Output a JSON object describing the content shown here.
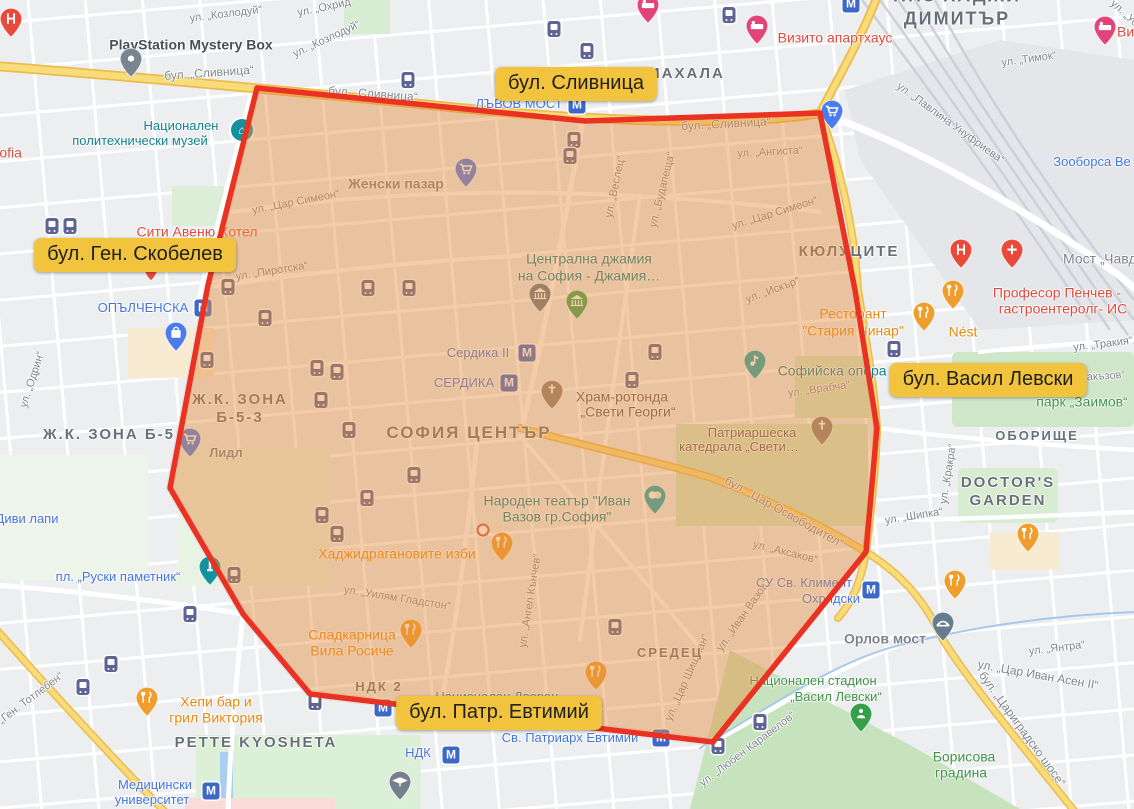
{
  "map": {
    "region": {
      "polygon_points": [
        [
          257,
          88
        ],
        [
          585,
          121
        ],
        [
          820,
          113
        ],
        [
          855,
          290
        ],
        [
          877,
          428
        ],
        [
          866,
          552
        ],
        [
          713,
          742
        ],
        [
          310,
          694
        ],
        [
          243,
          614
        ],
        [
          170,
          488
        ],
        [
          208,
          285
        ]
      ],
      "fill": "#e78f3f",
      "fill_opacity": 0.45,
      "stroke": "#ea3223",
      "stroke_width": 5.5
    },
    "callouts": [
      {
        "text": "бул. Сливница",
        "x": 576,
        "y": 84
      },
      {
        "text": "бул. Ген. Скобелев",
        "x": 135,
        "y": 255
      },
      {
        "text": "бул. Васил Левски",
        "x": 988,
        "y": 380
      },
      {
        "text": "бул. Патр. Евтимий",
        "x": 499,
        "y": 713
      }
    ],
    "labels": [
      {
        "t": "ул. „Козлодуй“",
        "x": 226,
        "y": 15,
        "c": "st",
        "r": -7
      },
      {
        "t": "ул. „Козлодуй“",
        "x": 327,
        "y": 40,
        "c": "st",
        "r": -25
      },
      {
        "t": "ул. „Охрид“",
        "x": 326,
        "y": 8,
        "c": "st",
        "r": -12
      },
      {
        "t": "бул. „Сливница“",
        "x": 209,
        "y": 73,
        "c": "st",
        "fs": 12,
        "r": -4
      },
      {
        "t": "бул. „Сливница“",
        "x": 373,
        "y": 94,
        "c": "st",
        "fs": 12,
        "r": 4
      },
      {
        "t": "бул. „Сливница“",
        "x": 726,
        "y": 124,
        "c": "st",
        "fs": 12,
        "r": -3
      },
      {
        "t": "ул. „Тимок“",
        "x": 1029,
        "y": 60,
        "c": "st",
        "r": -8
      },
      {
        "t": "ул. „Павлина Унуфриева“",
        "x": 950,
        "y": 124,
        "c": "st",
        "r": 36
      },
      {
        "t": "ул. „Уо",
        "x": 1124,
        "y": 14,
        "c": "st",
        "r": 42
      },
      {
        "t": "ул. „Ангиста“",
        "x": 770,
        "y": 153,
        "c": "st",
        "r": -3
      },
      {
        "t": "ул. „Веслец“",
        "x": 616,
        "y": 187,
        "c": "st",
        "r": -78
      },
      {
        "t": "ул. „Будапеща“",
        "x": 663,
        "y": 190,
        "c": "st",
        "r": -76
      },
      {
        "t": "ул. „Цар Симеон“",
        "x": 296,
        "y": 203,
        "c": "st",
        "r": -11
      },
      {
        "t": "ул. „Цар Симеон“",
        "x": 775,
        "y": 214,
        "c": "st",
        "r": -17
      },
      {
        "t": "ул. „Пиротска“",
        "x": 272,
        "y": 272,
        "c": "st",
        "r": -9
      },
      {
        "t": "ул. „Искър“",
        "x": 773,
        "y": 291,
        "c": "st",
        "r": -20
      },
      {
        "t": "ул. „Одрин“",
        "x": 33,
        "y": 380,
        "c": "st",
        "r": -72
      },
      {
        "t": "ул. „Врабча“",
        "x": 819,
        "y": 390,
        "c": "st",
        "r": -8
      },
      {
        "t": "бул. „Цар Освободител“",
        "x": 784,
        "y": 512,
        "c": "st",
        "fs": 12,
        "r": 29
      },
      {
        "t": "ул. „Аксаков“",
        "x": 785,
        "y": 553,
        "c": "st",
        "r": 14
      },
      {
        "t": "ул. „Тракия“",
        "x": 1103,
        "y": 345,
        "c": "st",
        "r": -7
      },
      {
        "t": "ул. „Кракра“",
        "x": 949,
        "y": 474,
        "c": "st",
        "r": -81
      },
      {
        "t": "ул. „Шипка“",
        "x": 914,
        "y": 517,
        "c": "st",
        "r": -9
      },
      {
        "t": "ул. „Янтра“",
        "x": 1057,
        "y": 649,
        "c": "st",
        "r": -7
      },
      {
        "t": "ул. „Цар Иван Асен II“",
        "x": 1038,
        "y": 675,
        "c": "st",
        "fs": 12,
        "r": 10
      },
      {
        "t": "бул. „Цариградско шосе“",
        "x": 1022,
        "y": 729,
        "c": "st",
        "fs": 12,
        "r": 54
      },
      {
        "t": "ул. „Любен Каравелов“",
        "x": 748,
        "y": 750,
        "c": "st",
        "r": -37
      },
      {
        "t": "ул. „Уилям Гладстон“",
        "x": 397,
        "y": 599,
        "c": "st",
        "r": 9
      },
      {
        "t": "ул. „Ангел Кънчев“",
        "x": 531,
        "y": 601,
        "c": "st",
        "r": -81
      },
      {
        "t": "ул. „Цар Шишман“",
        "x": 688,
        "y": 678,
        "c": "st",
        "r": -66
      },
      {
        "t": "ул. „Иван Вазов“",
        "x": 744,
        "y": 616,
        "c": "st",
        "r": -55
      },
      {
        "t": "бул. „Ген. Тотлебен“",
        "x": 22,
        "y": 706,
        "c": "st",
        "r": -37
      },
      {
        "t": "акъзов“",
        "x": 1106,
        "y": 377,
        "c": "st",
        "r": -4
      },
      {
        "t": "Мост „Чавдар“",
        "x": 1110,
        "y": 259,
        "c": "st",
        "fs": 14
      },
      {
        "t": "МАХАЛА",
        "x": 686,
        "y": 74,
        "c": "area",
        "fs": 15
      },
      {
        "t": "НПЗ ХАДЖИ",
        "x": 957,
        "y": -4,
        "c": "area",
        "fs": 18
      },
      {
        "t": "ДИМИТЪР",
        "x": 957,
        "y": 19,
        "c": "area",
        "fs": 18
      },
      {
        "t": "КЮЛУЦИТЕ",
        "x": 849,
        "y": 252,
        "c": "area",
        "fs": 15
      },
      {
        "t": "Ж.К. ЗОНА Б-5",
        "x": 109,
        "y": 435,
        "c": "area",
        "fs": 15
      },
      {
        "t": "Ж.К. ЗОНА",
        "x": 240,
        "y": 400,
        "c": "area",
        "fs": 15
      },
      {
        "t": "Б-5-3",
        "x": 240,
        "y": 418,
        "c": "area",
        "fs": 15
      },
      {
        "t": "СОФИЯ ЦЕНТЪР",
        "x": 469,
        "y": 433,
        "c": "area",
        "fs": 17
      },
      {
        "t": "СРЕДЕЦ",
        "x": 670,
        "y": 653,
        "c": "area",
        "fs": 13
      },
      {
        "t": "ОБОРИЩЕ",
        "x": 1037,
        "y": 436,
        "c": "area",
        "fs": 13
      },
      {
        "t": "DOCTOR'S",
        "x": 1008,
        "y": 483,
        "c": "area",
        "fs": 15
      },
      {
        "t": "GARDEN",
        "x": 1008,
        "y": 501,
        "c": "area",
        "fs": 15
      },
      {
        "t": "PETTE KYOSHETA",
        "x": 256,
        "y": 743,
        "c": "area",
        "fs": 15
      },
      {
        "t": "НДК 2",
        "x": 379,
        "y": 687,
        "c": "area",
        "fs": 13
      },
      {
        "t": "ОПЪЛЧЕНСКА",
        "x": 143,
        "y": 308,
        "c": "blue",
        "fs": 13
      },
      {
        "t": "ЛЪВОВ МОСТ",
        "x": 519,
        "y": 104,
        "c": "blue",
        "fs": 13
      },
      {
        "t": "Сердика II",
        "x": 478,
        "y": 353,
        "c": "blue",
        "fs": 13
      },
      {
        "t": "СЕРДИКА",
        "x": 464,
        "y": 383,
        "c": "blue",
        "fs": 13
      },
      {
        "t": "Медицински",
        "x": 155,
        "y": 785,
        "c": "blue",
        "fs": 13
      },
      {
        "t": "университет",
        "x": 152,
        "y": 800,
        "c": "blue",
        "fs": 13
      },
      {
        "t": "НДК",
        "x": 418,
        "y": 753,
        "c": "blue",
        "fs": 13
      },
      {
        "t": "Св. Патриарх Евтимий",
        "x": 570,
        "y": 738,
        "c": "blue",
        "fs": 13
      },
      {
        "t": "СУ Св. Климент",
        "x": 804,
        "y": 583,
        "c": "blue",
        "fs": 13
      },
      {
        "t": "Охридски",
        "x": 831,
        "y": 599,
        "c": "blue",
        "fs": 13
      },
      {
        "t": "пл. „Руски паметник“",
        "x": 118,
        "y": 577,
        "c": "blue",
        "fs": 13
      },
      {
        "t": "Диви лапи",
        "x": 27,
        "y": 519,
        "c": "blue",
        "fs": 13
      },
      {
        "t": "Зооборса Ве",
        "x": 1092,
        "y": 162,
        "c": "blue",
        "fs": 13
      },
      {
        "t": "Национален",
        "x": 181,
        "y": 126,
        "c": "teal",
        "fs": 13
      },
      {
        "t": "политехнически музей",
        "x": 140,
        "y": 141,
        "c": "teal",
        "fs": 13
      },
      {
        "t": "Централна джамия",
        "x": 589,
        "y": 259,
        "c": "teal",
        "fs": 14
      },
      {
        "t": "на София - Джамия…",
        "x": 589,
        "y": 276,
        "c": "teal",
        "fs": 14
      },
      {
        "t": "Народен театър \"Иван",
        "x": 557,
        "y": 501,
        "c": "teal",
        "fs": 14
      },
      {
        "t": "Вазов гр.София\"",
        "x": 557,
        "y": 517,
        "c": "teal",
        "fs": 14
      },
      {
        "t": "Софийска опера и",
        "x": 838,
        "y": 371,
        "c": "teal",
        "fs": 14
      },
      {
        "t": "Национален Дворец",
        "x": 497,
        "y": 697,
        "c": "teal",
        "fs": 13
      },
      {
        "t": "Храм-ротонда",
        "x": 622,
        "y": 397,
        "c": "brown",
        "fs": 14
      },
      {
        "t": "„Свети Георги“",
        "x": 628,
        "y": 412,
        "c": "brown",
        "fs": 14
      },
      {
        "t": "Патриаршеска",
        "x": 752,
        "y": 433,
        "c": "brown",
        "fs": 13
      },
      {
        "t": "катедрала „Свети…",
        "x": 739,
        "y": 447,
        "c": "brown",
        "fs": 13
      },
      {
        "t": "Орлов мост",
        "x": 885,
        "y": 639,
        "c": "gray",
        "fs": 14
      },
      {
        "t": "Женски пазар",
        "x": 396,
        "y": 184,
        "c": "gray",
        "fs": 14
      },
      {
        "t": "Лидл",
        "x": 226,
        "y": 453,
        "c": "gray",
        "fs": 13
      },
      {
        "t": "PlayStation Mystery Box",
        "x": 191,
        "y": 45,
        "c": "dark",
        "fs": 14
      },
      {
        "t": "Sofia",
        "x": 6,
        "y": 153,
        "c": "red",
        "fs": 14
      },
      {
        "t": "Сити Авеню Хотел",
        "x": 197,
        "y": 232,
        "c": "red",
        "fs": 14
      },
      {
        "t": "Визито апартхаус",
        "x": 835,
        "y": 38,
        "c": "red",
        "fs": 14
      },
      {
        "t": "Визито апартхаус",
        "x": 1117,
        "y": 32,
        "c": "red",
        "fs": 14,
        "a": "l"
      },
      {
        "t": "Професор Пенчев -",
        "x": 1057,
        "y": 293,
        "c": "red",
        "fs": 14
      },
      {
        "t": "гастроентеролг- ИС",
        "x": 1063,
        "y": 309,
        "c": "red",
        "fs": 14
      },
      {
        "t": "Ресторант",
        "x": 853,
        "y": 314,
        "c": "orange",
        "fs": 14
      },
      {
        "t": "\"Стария Чинар\"",
        "x": 853,
        "y": 331,
        "c": "orange",
        "fs": 14
      },
      {
        "t": "Nést",
        "x": 963,
        "y": 332,
        "c": "orange",
        "fs": 14
      },
      {
        "t": "Хаджидрагановите изби",
        "x": 397,
        "y": 554,
        "c": "orange",
        "fs": 14
      },
      {
        "t": "Сладкарница",
        "x": 352,
        "y": 635,
        "c": "orange",
        "fs": 14
      },
      {
        "t": "Вила Росиче",
        "x": 352,
        "y": 651,
        "c": "orange",
        "fs": 14
      },
      {
        "t": "Хепи бар и",
        "x": 216,
        "y": 702,
        "c": "orange",
        "fs": 14
      },
      {
        "t": "грил Виктория",
        "x": 216,
        "y": 718,
        "c": "orange",
        "fs": 14
      },
      {
        "t": "парк „Заимов“",
        "x": 1082,
        "y": 402,
        "c": "green",
        "fs": 14
      },
      {
        "t": "Национален стадион",
        "x": 813,
        "y": 681,
        "c": "green",
        "fs": 13
      },
      {
        "t": "„Васил Левски“",
        "x": 836,
        "y": 697,
        "c": "green",
        "fs": 13
      },
      {
        "t": "Борисова",
        "x": 964,
        "y": 757,
        "c": "green",
        "fs": 14
      },
      {
        "t": "градина",
        "x": 961,
        "y": 773,
        "c": "green",
        "fs": 14
      }
    ],
    "icons": {
      "metro_label": "М",
      "metro": [
        [
          203,
          308
        ],
        [
          577,
          105
        ],
        [
          527,
          353
        ],
        [
          509,
          383
        ],
        [
          211,
          791
        ],
        [
          451,
          755
        ],
        [
          661,
          738
        ],
        [
          871,
          590
        ],
        [
          851,
          4
        ],
        [
          383,
          708
        ]
      ],
      "tram": [
        [
          52,
          226
        ],
        [
          70,
          226
        ],
        [
          226,
          262
        ],
        [
          228,
          287
        ],
        [
          368,
          288
        ],
        [
          409,
          288
        ],
        [
          265,
          318
        ],
        [
          207,
          360
        ],
        [
          317,
          368
        ],
        [
          337,
          372
        ],
        [
          321,
          400
        ],
        [
          349,
          430
        ],
        [
          414,
          475
        ],
        [
          367,
          498
        ],
        [
          322,
          515
        ],
        [
          337,
          534
        ],
        [
          554,
          29
        ],
        [
          587,
          51
        ],
        [
          729,
          15
        ],
        [
          408,
          80
        ],
        [
          574,
          140
        ],
        [
          570,
          156
        ],
        [
          655,
          352
        ],
        [
          632,
          380
        ],
        [
          894,
          349
        ],
        [
          190,
          614
        ],
        [
          234,
          575
        ],
        [
          111,
          664
        ],
        [
          83,
          687
        ],
        [
          615,
          627
        ],
        [
          718,
          746
        ],
        [
          760,
          722
        ],
        [
          315,
          702
        ]
      ],
      "pins": [
        {
          "k": "hospital",
          "x": 11,
          "y": 27
        },
        {
          "k": "hospital",
          "x": 961,
          "y": 258
        },
        {
          "k": "medbldg",
          "x": 1012,
          "y": 258
        },
        {
          "k": "bed",
          "x": 757,
          "y": 34
        },
        {
          "k": "bed",
          "x": 1105,
          "y": 35
        },
        {
          "k": "bed",
          "x": 648,
          "y": 13
        },
        {
          "k": "restaurant",
          "x": 924,
          "y": 321
        },
        {
          "k": "restaurant",
          "x": 953,
          "y": 299
        },
        {
          "k": "restaurant",
          "x": 502,
          "y": 551
        },
        {
          "k": "restaurant",
          "x": 596,
          "y": 680
        },
        {
          "k": "restaurant",
          "x": 147,
          "y": 706
        },
        {
          "k": "restaurant",
          "x": 1028,
          "y": 542
        },
        {
          "k": "restaurant",
          "x": 955,
          "y": 589
        },
        {
          "k": "cafe",
          "x": 411,
          "y": 638
        },
        {
          "k": "cart",
          "x": 832,
          "y": 119
        },
        {
          "k": "cart",
          "x": 190,
          "y": 447
        },
        {
          "k": "cart",
          "x": 466,
          "y": 177
        },
        {
          "k": "bag",
          "x": 176,
          "y": 341
        },
        {
          "k": "museum",
          "x": 540,
          "y": 302
        },
        {
          "k": "museumg",
          "x": 577,
          "y": 309
        },
        {
          "k": "church",
          "x": 552,
          "y": 399
        },
        {
          "k": "church",
          "x": 822,
          "y": 435
        },
        {
          "k": "theater",
          "x": 655,
          "y": 504
        },
        {
          "k": "music",
          "x": 755,
          "y": 369
        },
        {
          "k": "bridge",
          "x": 943,
          "y": 631
        },
        {
          "k": "grad",
          "x": 400,
          "y": 790
        },
        {
          "k": "park",
          "x": 861,
          "y": 722
        },
        {
          "k": "obelisk",
          "x": 210,
          "y": 575
        },
        {
          "k": "plain",
          "x": 131,
          "y": 67
        },
        {
          "k": "minired",
          "x": 151,
          "y": 276
        }
      ],
      "special": [
        {
          "k": "politeh",
          "x": 242,
          "y": 130,
          "glyph": "⌂"
        },
        {
          "k": "whitedot",
          "x": 483,
          "y": 530
        }
      ]
    }
  }
}
